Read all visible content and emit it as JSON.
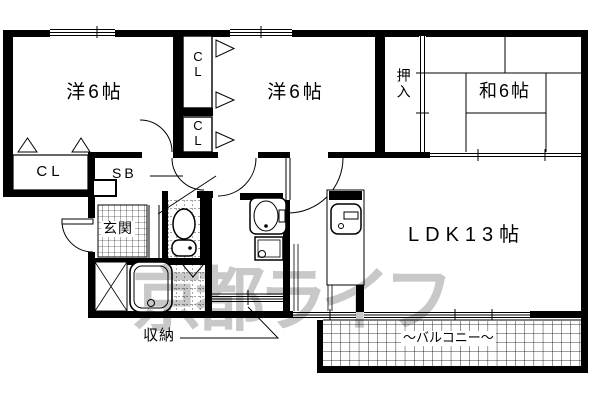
{
  "meta": {
    "type": "apartment-floorplan",
    "background_color": "#ffffff",
    "line_color": "#000000",
    "watermark_color": "#c8c8c8"
  },
  "rooms": {
    "western1": "洋6帖",
    "western2": "洋6帖",
    "japanese": "和6帖",
    "ldk": "LDK13帖",
    "oshiire": "押入",
    "closet_upper": "C\nL",
    "closet_lower": "C\nL",
    "closet_left": "CL",
    "shoe_box": "SB",
    "entrance": "玄関",
    "storage": "収納",
    "balcony": "バルコニー",
    "balcony_prefix": "〜",
    "balcony_suffix": "〜"
  },
  "watermark": "京都ライフ"
}
